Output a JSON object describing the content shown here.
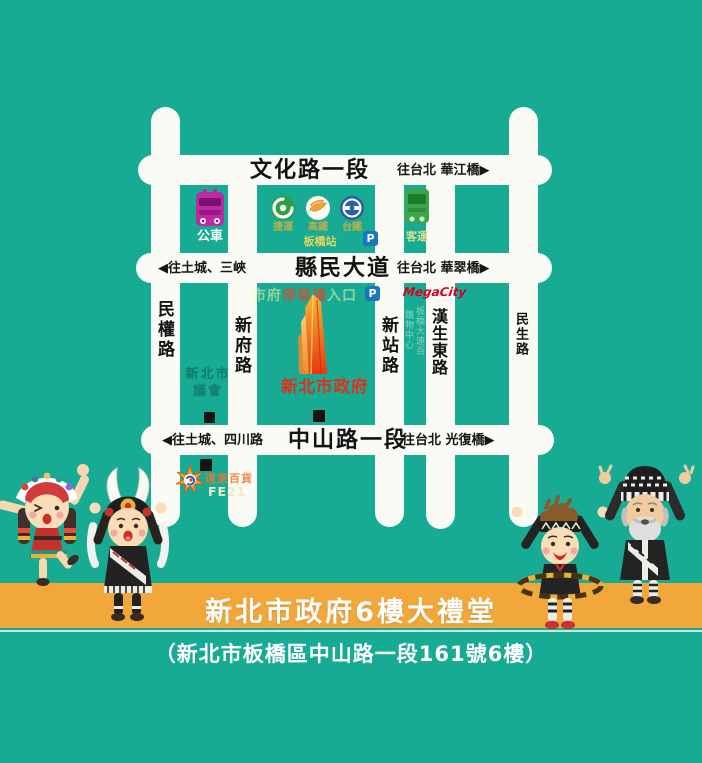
{
  "colors": {
    "background_teal": "#17AB94",
    "road_white": "#FBFBF6",
    "banner_orange": "#F2A73B",
    "cityhall_red": "#E0301A",
    "bus_icon_magenta": "#BB2AA0",
    "coach_icon_green": "#3BA647",
    "parking_blue": "#1B75BB",
    "mrt_logo_green": "#2E9E41",
    "hsr_logo_orange": "#E8A33D",
    "tra_logo_blue": "#2B5FA8",
    "fe21_star_orange": "#F59E2A"
  },
  "map": {
    "horizontal_roads": [
      {
        "label": "文化路一段",
        "east_hint": "往台北 華江橋▶"
      },
      {
        "label": "縣民大道",
        "west_hint": "◀往土城、三峽",
        "east_hint": "往台北 華翠橋▶"
      },
      {
        "label": "中山路一段",
        "west_hint": "◀往土城、四川路",
        "east_hint": "往台北 光復橋▶"
      }
    ],
    "vertical_roads": [
      {
        "label": "民權路"
      },
      {
        "label": "新府路"
      },
      {
        "label": "新站路"
      },
      {
        "label": "漢生東路"
      },
      {
        "label": "民生路"
      }
    ],
    "pois": {
      "city_bus": {
        "label": "公車",
        "icon": "bus-icon"
      },
      "station": {
        "logos": [
          {
            "label": "捷運",
            "icon": "mrt-logo"
          },
          {
            "label": "高鐵",
            "icon": "hsr-logo"
          },
          {
            "label": "台鐵",
            "icon": "tra-logo"
          }
        ],
        "name": "板橋站"
      },
      "parking_label": "P",
      "coach_bus": {
        "label": "客運",
        "icon": "coach-icon"
      },
      "plaza_note": {
        "prefix": "市府",
        "highlight": "停車場",
        "suffix": "入口"
      },
      "council": {
        "line1": "新北市",
        "line2": "議會"
      },
      "city_hall": {
        "name": "新北市政府",
        "icon": "city-hall-tower"
      },
      "megacity": {
        "logo": "MegaCity",
        "vertical1": "購物中心",
        "vertical2": "板橋大遠百"
      },
      "fe21": {
        "name": "遠東百貨",
        "code": "FE21",
        "icon": "fe21-star"
      }
    }
  },
  "characters": {
    "left_girl": "indigenous-girl-dancing",
    "left_boy": "indigenous-boy-dancing",
    "right_boy": "indigenous-boy-hula-hoop",
    "right_elder": "indigenous-elder-cheering"
  },
  "footer": {
    "venue": "新北市政府6樓大禮堂",
    "address": "（新北市板橋區中山路一段161號6樓）"
  }
}
